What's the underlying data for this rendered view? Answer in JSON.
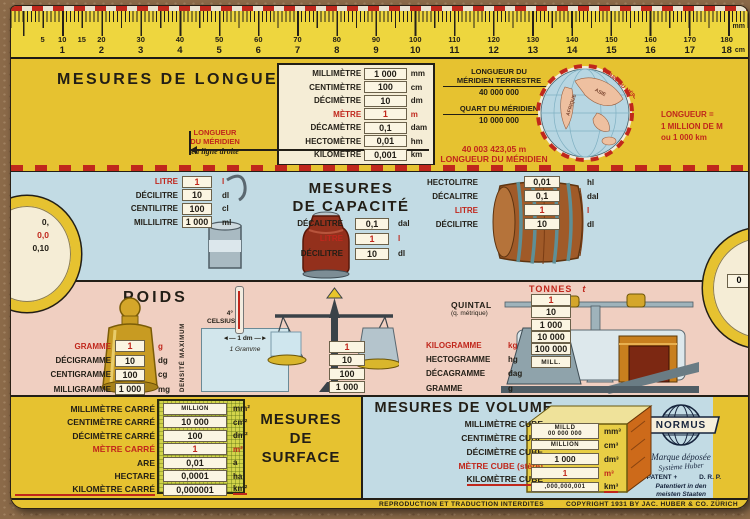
{
  "colors": {
    "card_yellow": "#e6c230",
    "section_blue": "#c2dbe4",
    "section_pink": "#f0cfc1",
    "accent_red": "#c0271c",
    "window_cream": "#f5edd6",
    "ink_black": "#221e16"
  },
  "ruler": {
    "unit_top": "mm",
    "unit_bottom": "cm",
    "mm_labels": [
      {
        "t": "5",
        "p": 4.29
      },
      {
        "t": "10",
        "p": 6.95
      },
      {
        "t": "15",
        "p": 9.61
      },
      {
        "t": "20",
        "p": 12.27
      },
      {
        "t": "30",
        "p": 17.6
      },
      {
        "t": "40",
        "p": 22.92
      },
      {
        "t": "50",
        "p": 28.24
      },
      {
        "t": "60",
        "p": 33.56
      },
      {
        "t": "70",
        "p": 38.88
      },
      {
        "t": "80",
        "p": 44.21
      },
      {
        "t": "90",
        "p": 49.53
      },
      {
        "t": "100",
        "p": 54.85
      },
      {
        "t": "110",
        "p": 60.17
      },
      {
        "t": "120",
        "p": 65.49
      },
      {
        "t": "130",
        "p": 70.82
      },
      {
        "t": "140",
        "p": 76.14
      },
      {
        "t": "150",
        "p": 81.46
      },
      {
        "t": "160",
        "p": 86.78
      },
      {
        "t": "170",
        "p": 92.1
      },
      {
        "t": "180",
        "p": 97.1
      }
    ],
    "cm_labels": [
      {
        "t": "1",
        "p": 6.95
      },
      {
        "t": "2",
        "p": 12.27
      },
      {
        "t": "3",
        "p": 17.6
      },
      {
        "t": "4",
        "p": 22.92
      },
      {
        "t": "5",
        "p": 28.24
      },
      {
        "t": "6",
        "p": 33.56
      },
      {
        "t": "7",
        "p": 38.88
      },
      {
        "t": "8",
        "p": 44.21
      },
      {
        "t": "9",
        "p": 49.53
      },
      {
        "t": "10",
        "p": 54.85
      },
      {
        "t": "11",
        "p": 60.17
      },
      {
        "t": "12",
        "p": 65.49
      },
      {
        "t": "13",
        "p": 70.82
      },
      {
        "t": "14",
        "p": 76.14
      },
      {
        "t": "15",
        "p": 81.46
      },
      {
        "t": "16",
        "p": 86.78
      },
      {
        "t": "17",
        "p": 92.1
      },
      {
        "t": "18",
        "p": 97.1
      }
    ]
  },
  "length": {
    "title": "MESURES DE LONGUEUR",
    "rows": [
      {
        "label": "MILLIMÈTRE",
        "value": "1 000",
        "unit": "mm"
      },
      {
        "label": "CENTIMÈTRE",
        "value": "100",
        "unit": "cm"
      },
      {
        "label": "DÉCIMÈTRE",
        "value": "10",
        "unit": "dm"
      },
      {
        "label": "MÈTRE",
        "value": "1",
        "unit": "m",
        "red": true
      },
      {
        "label": "DÉCAMÈTRE",
        "value": "0,1",
        "unit": "dam"
      },
      {
        "label": "HECTOMÈTRE",
        "value": "0,01",
        "unit": "hm"
      },
      {
        "label": "KILOMÈTRE",
        "value": "0,001",
        "unit": "km"
      }
    ],
    "fraction1": {
      "num_line1": "LONGUEUR DU",
      "num_line2": "MÉRIDIEN TERRESTRE",
      "den": "40 000 000",
      "eq": "= 1 m"
    },
    "fraction2": {
      "num_line1": "QUART DU MÉRIDIEN",
      "den": "10 000 000",
      "eq": "= 1 m"
    },
    "meridien_left": {
      "line1": "LONGUEUR",
      "line2": "DU MÉRIDIEN",
      "line3": "en ligne droite"
    },
    "meridien_value": "40 003 423,05 m",
    "meridien_value_label": "LONGUEUR DU MÉRIDIEN",
    "right_note": {
      "line1": "LONGUEUR =",
      "line2": "1 MILLION DE M",
      "line3": "ou 1 000 km"
    },
    "globe": {
      "label_africa": "AFRIQUE",
      "label_asia": "ASIE",
      "rim_label": "QUART DU MÉRIDIEN"
    }
  },
  "capacity": {
    "title_line1": "MESURES",
    "title_line2": "DE CAPACITÉ",
    "cup_rows": [
      {
        "label": "LITRE",
        "value": "1",
        "unit": "l",
        "red": true
      },
      {
        "label": "DÉCILITRE",
        "value": "10",
        "unit": "dl"
      },
      {
        "label": "CENTILITRE",
        "value": "100",
        "unit": "cl"
      },
      {
        "label": "MILLILITRE",
        "value": "1 000",
        "unit": "ml"
      }
    ],
    "can_rows": [
      {
        "label": "DÉCALITRE",
        "value": "0,1",
        "unit": "dal"
      },
      {
        "label": "LITRE",
        "value": "1",
        "unit": "l",
        "red": true
      },
      {
        "label": "DÉCILITRE",
        "value": "10",
        "unit": "dl"
      }
    ],
    "barrel_rows": [
      {
        "label": "HECTOLITRE",
        "value": "0,01",
        "unit": "hl"
      },
      {
        "label": "DÉCALITRE",
        "value": "0,1",
        "unit": "dal"
      },
      {
        "label": "LITRE",
        "value": "1",
        "unit": "l",
        "red": true
      },
      {
        "label": "DÉCILITRE",
        "value": "10",
        "unit": "dl"
      }
    ],
    "left_cutout": [
      {
        "t": "0,"
      },
      {
        "t": "0,0",
        "red": true
      },
      {
        "t": "0,10"
      }
    ],
    "right_cutout": "0"
  },
  "weights": {
    "title": "POIDS",
    "gram_rows": [
      {
        "label": "GRAMME",
        "value": "1",
        "unit": "g",
        "red": true
      },
      {
        "label": "DÉCIGRAMME",
        "value": "10",
        "unit": "dg"
      },
      {
        "label": "CENTIGRAMME",
        "value": "100",
        "unit": "cg"
      },
      {
        "label": "MILLIGRAMME",
        "value": "1 000",
        "unit": "mg"
      }
    ],
    "density": {
      "temp": "4°",
      "temp_unit": "CELSIUS",
      "side": "DENSITÉ MAXIMUM",
      "dim": "◄— 1 dm —►",
      "weight": "1 Gramme"
    },
    "balance_values": [
      {
        "t": "1",
        "red": true
      },
      {
        "t": "10"
      },
      {
        "t": "100"
      },
      {
        "t": "1 000"
      }
    ],
    "quintal": "QUINTAL",
    "quintal_sub": "(q. métrique)",
    "kilo_rows": [
      {
        "label": "KILOGRAMME",
        "unit": "kg",
        "red": true
      },
      {
        "label": "HECTOGRAMME",
        "unit": "hg"
      },
      {
        "label": "DÉCAGRAMME",
        "unit": "dag"
      },
      {
        "label": "GRAMME",
        "unit": "g"
      }
    ],
    "tonnes_label": "TONNES",
    "tonnes_unit": "t",
    "tonne_values": [
      {
        "t": "1",
        "red": true
      },
      {
        "t": "10"
      },
      {
        "t": "1 000"
      },
      {
        "t": "10 000"
      },
      {
        "t": "100 000"
      },
      {
        "t": "MILL."
      }
    ]
  },
  "surface": {
    "title_line1": "MESURES",
    "title_line2": "DE",
    "title_line3": "SURFACE",
    "rows": [
      {
        "label": "MILLIMÈTRE CARRÉ",
        "value": "MILLION",
        "unit": "mm²",
        "small": true
      },
      {
        "label": "CENTIMÈTRE CARRÉ",
        "value": "10 000",
        "unit": "cm²"
      },
      {
        "label": "DÉCIMÈTRE CARRÉ",
        "value": "100",
        "unit": "dm²"
      },
      {
        "label": "MÈTRE CARRÉ",
        "value": "1",
        "unit": "m²",
        "red": true
      },
      {
        "label": "ARE",
        "value": "0,01",
        "unit": "a"
      },
      {
        "label": "HECTARE",
        "value": "0,0001",
        "unit": "ha"
      },
      {
        "label": "KILOMÈTRE CARRÉ",
        "value": "0,000001",
        "unit": "km²",
        "underl": true
      }
    ]
  },
  "volume": {
    "title": "MESURES DE VOLUME",
    "labels": [
      {
        "t": "MILLIMÈTRE CUBE"
      },
      {
        "t": "CENTIMÈTRE CUBE"
      },
      {
        "t": "DÉCIMÈTRE CUBE"
      },
      {
        "t": "MÈTRE CUBE (stère)",
        "red": true
      },
      {
        "t": "KILOMÈTRE CUBE",
        "underl": true
      }
    ],
    "cube_rows": [
      {
        "v1": "MILLD",
        "v2": "00 000 000",
        "unit": "mm³",
        "small": true
      },
      {
        "v1": "MILLION",
        "v2": "",
        "unit": "cm³",
        "small": true
      },
      {
        "v1": "1 000",
        "v2": "",
        "unit": "dm³"
      },
      {
        "v1": "1",
        "v2": "",
        "unit": "m³",
        "red": true
      },
      {
        "v1": ",000,000,001",
        "v2": "",
        "unit": "km³",
        "small": true,
        "underl": true
      }
    ]
  },
  "normus": {
    "name": "NORMUS",
    "line1": "Marque déposée",
    "line2": "Système Huber",
    "line3a": "+ PATENT +",
    "line3b": "D. R. P.",
    "line4": "Patentiert in den",
    "line5": "meisten Staaten"
  },
  "footer": {
    "left": "REPRODUCTION ET TRADUCTION INTERDITES",
    "right": "COPYRIGHT 1931 BY JAC. HUBER & CO. ZÜRICH"
  }
}
